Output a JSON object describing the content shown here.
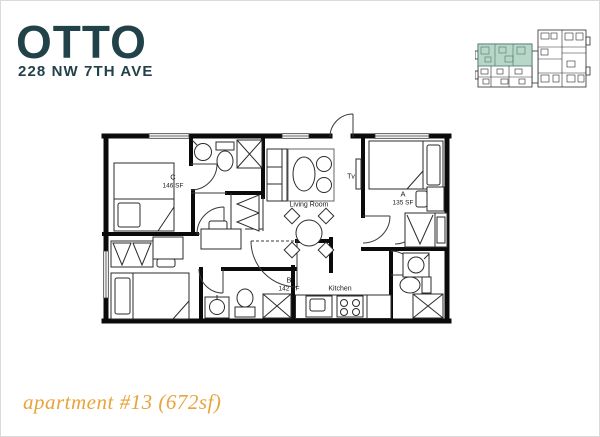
{
  "brand": {
    "logo": "OTTO",
    "address": "228 NW 7TH AVE",
    "color": "#22424a"
  },
  "key_plan": {
    "highlight_color": "#b9d7c9",
    "highlight_line_color": "#477568"
  },
  "rooms": {
    "bedroom_c": {
      "letter": "C",
      "area": "146 SF"
    },
    "bedroom_a": {
      "letter": "A",
      "area": "135 SF"
    },
    "bedroom_b": {
      "letter": "B",
      "area": "142 SF"
    },
    "living_room": {
      "label": "Living Room"
    },
    "tv": {
      "label": "Tv"
    },
    "kitchen": {
      "label": "Kitchen"
    }
  },
  "caption": {
    "text": "apartment #13 (672sf)",
    "color": "#e7a43c"
  }
}
